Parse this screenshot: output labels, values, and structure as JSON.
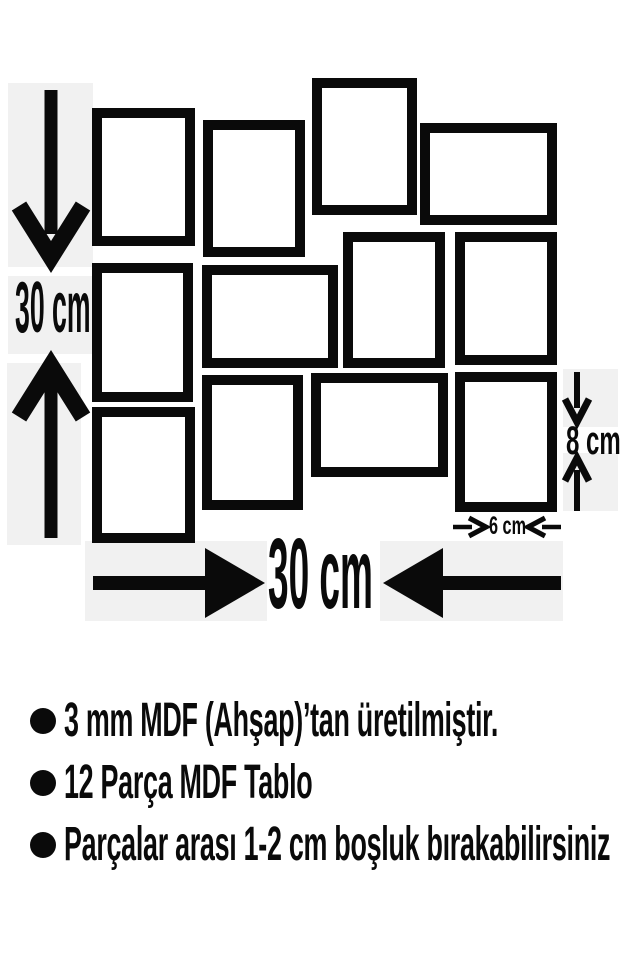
{
  "diagram": {
    "frames": [
      {
        "x": 92,
        "y": 108,
        "w": 103,
        "h": 138
      },
      {
        "x": 203,
        "y": 120,
        "w": 102,
        "h": 137
      },
      {
        "x": 312,
        "y": 78,
        "w": 105,
        "h": 137
      },
      {
        "x": 420,
        "y": 123,
        "w": 137,
        "h": 102
      },
      {
        "x": 92,
        "y": 263,
        "w": 101,
        "h": 139
      },
      {
        "x": 202,
        "y": 265,
        "w": 136,
        "h": 103
      },
      {
        "x": 343,
        "y": 232,
        "w": 102,
        "h": 136
      },
      {
        "x": 455,
        "y": 232,
        "w": 102,
        "h": 133
      },
      {
        "x": 92,
        "y": 407,
        "w": 103,
        "h": 136
      },
      {
        "x": 202,
        "y": 375,
        "w": 101,
        "h": 135
      },
      {
        "x": 311,
        "y": 373,
        "w": 137,
        "h": 104
      },
      {
        "x": 455,
        "y": 372,
        "w": 102,
        "h": 140
      }
    ],
    "labels": {
      "height": "30 cm",
      "width": "30 cm",
      "piece_height": "8 cm",
      "piece_width": "6 cm"
    },
    "icons": {
      "height_arrow_down": "↓",
      "height_arrow_up": "↑",
      "width_arrow_right": "→",
      "width_arrow_left": "←",
      "piece_height_arrow_down": "↓",
      "piece_height_arrow_up": "↑",
      "piece_width_arrow_right": "→",
      "piece_width_arrow_left": "←",
      "bullet": "●"
    },
    "colors": {
      "frame": "#0a0a0a",
      "backdrop": "#f1f1f1",
      "fill": "#ffffff"
    }
  },
  "notes": {
    "items": [
      "3 mm MDF (Ahşap)’tan üretilmiştir.",
      "12 Parça MDF Tablo",
      "Parçalar arası 1-2 cm boşluk bırakabilirsiniz"
    ]
  }
}
